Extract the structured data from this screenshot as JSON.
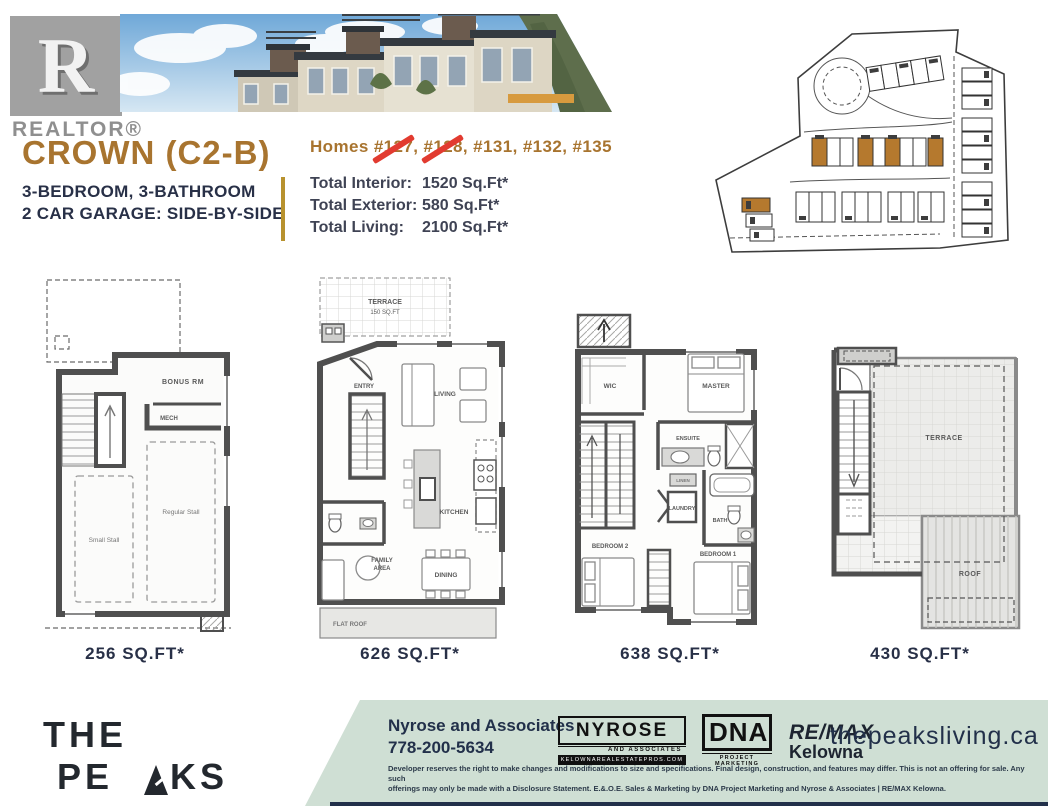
{
  "colors": {
    "bronze": "#a8742f",
    "navy": "#283047",
    "gold": "#b8922e",
    "red": "#e23b30",
    "footer_green": "#cfdfd4"
  },
  "brand": {
    "realtor_text": "REALTOR®",
    "realtor_r": "R",
    "peaks_pre": "THE PE",
    "peaks_post": "KS",
    "peaks_location": "—  KELOWNA, BC  —"
  },
  "header": {
    "title": "CROWN (C2-B)",
    "subtitle_line1": "3-BEDROOM, 3-BATHROOM",
    "subtitle_line2": "2 CAR GARAGE: SIDE-BY-SIDE",
    "homes_prefix": "Homes ",
    "homes": [
      {
        "num": "#127",
        "sep": ", ",
        "crossed": true
      },
      {
        "num": "#128",
        "sep": ", ",
        "crossed": true
      },
      {
        "num": "#131",
        "sep": ", ",
        "crossed": false
      },
      {
        "num": "#132",
        "sep": ", ",
        "crossed": false
      },
      {
        "num": "#135",
        "sep": "",
        "crossed": false
      }
    ],
    "totals": [
      {
        "label": "Total Interior:",
        "value": "1520 Sq.Ft*"
      },
      {
        "label": "Total Exterior:",
        "value": "580 Sq.Ft*"
      },
      {
        "label": "Total Living:",
        "value": "2100 Sq.Ft*"
      }
    ]
  },
  "plans": {
    "p1": {
      "area": "256 SQ.FT*",
      "bonus": "BONUS RM",
      "mech": "MECH",
      "small_stall": "Small Stall",
      "regular_stall": "Regular Stall"
    },
    "p2": {
      "area": "626 SQ.FT*",
      "terrace": "TERRACE",
      "terrace_size": "150 SQ.FT",
      "entry": "ENTRY",
      "living": "LIVING",
      "kitchen": "KITCHEN",
      "family1": "FAMILY",
      "family2": "AREA",
      "dining": "DINING",
      "flat_roof": "FLAT ROOF"
    },
    "p3": {
      "area": "638 SQ.FT*",
      "wic": "WIC",
      "master": "MASTER",
      "ensuite": "ENSUITE",
      "linen": "LINEN",
      "laundry": "LAUNDRY",
      "bath": "BATH",
      "bedroom2": "BEDROOM 2",
      "bedroom1": "BEDROOM 1"
    },
    "p4": {
      "area": "430 SQ.FT*",
      "terrace": "TERRACE",
      "roof": "ROOF"
    }
  },
  "footer": {
    "agent_name": "Nyrose and Associates",
    "agent_phone": "778-200-5634",
    "nyrose_logo": {
      "line1": "NYROSE",
      "line2": "AND ASSOCIATES",
      "line3": "KELOWNAREALESTATEPROS.COM"
    },
    "dna_logo": {
      "line1": "DNA",
      "line2": "PROJECT MARKETING"
    },
    "remax": {
      "line1": "RE/MAX",
      "line2": "Kelowna"
    },
    "website": "thepeaksliving.ca",
    "disclaimer_line1": "Developer reserves the right to make changes and modifications to size and specifications. Final design, construction, and features may differ. This is not an offering for sale. Any such",
    "disclaimer_line2": "offerings may only be made with a Disclosure Statement. E.&.O.E. Sales & Marketing by DNA Project Marketing and Nyrose & Associates | RE/MAX Kelowna."
  }
}
